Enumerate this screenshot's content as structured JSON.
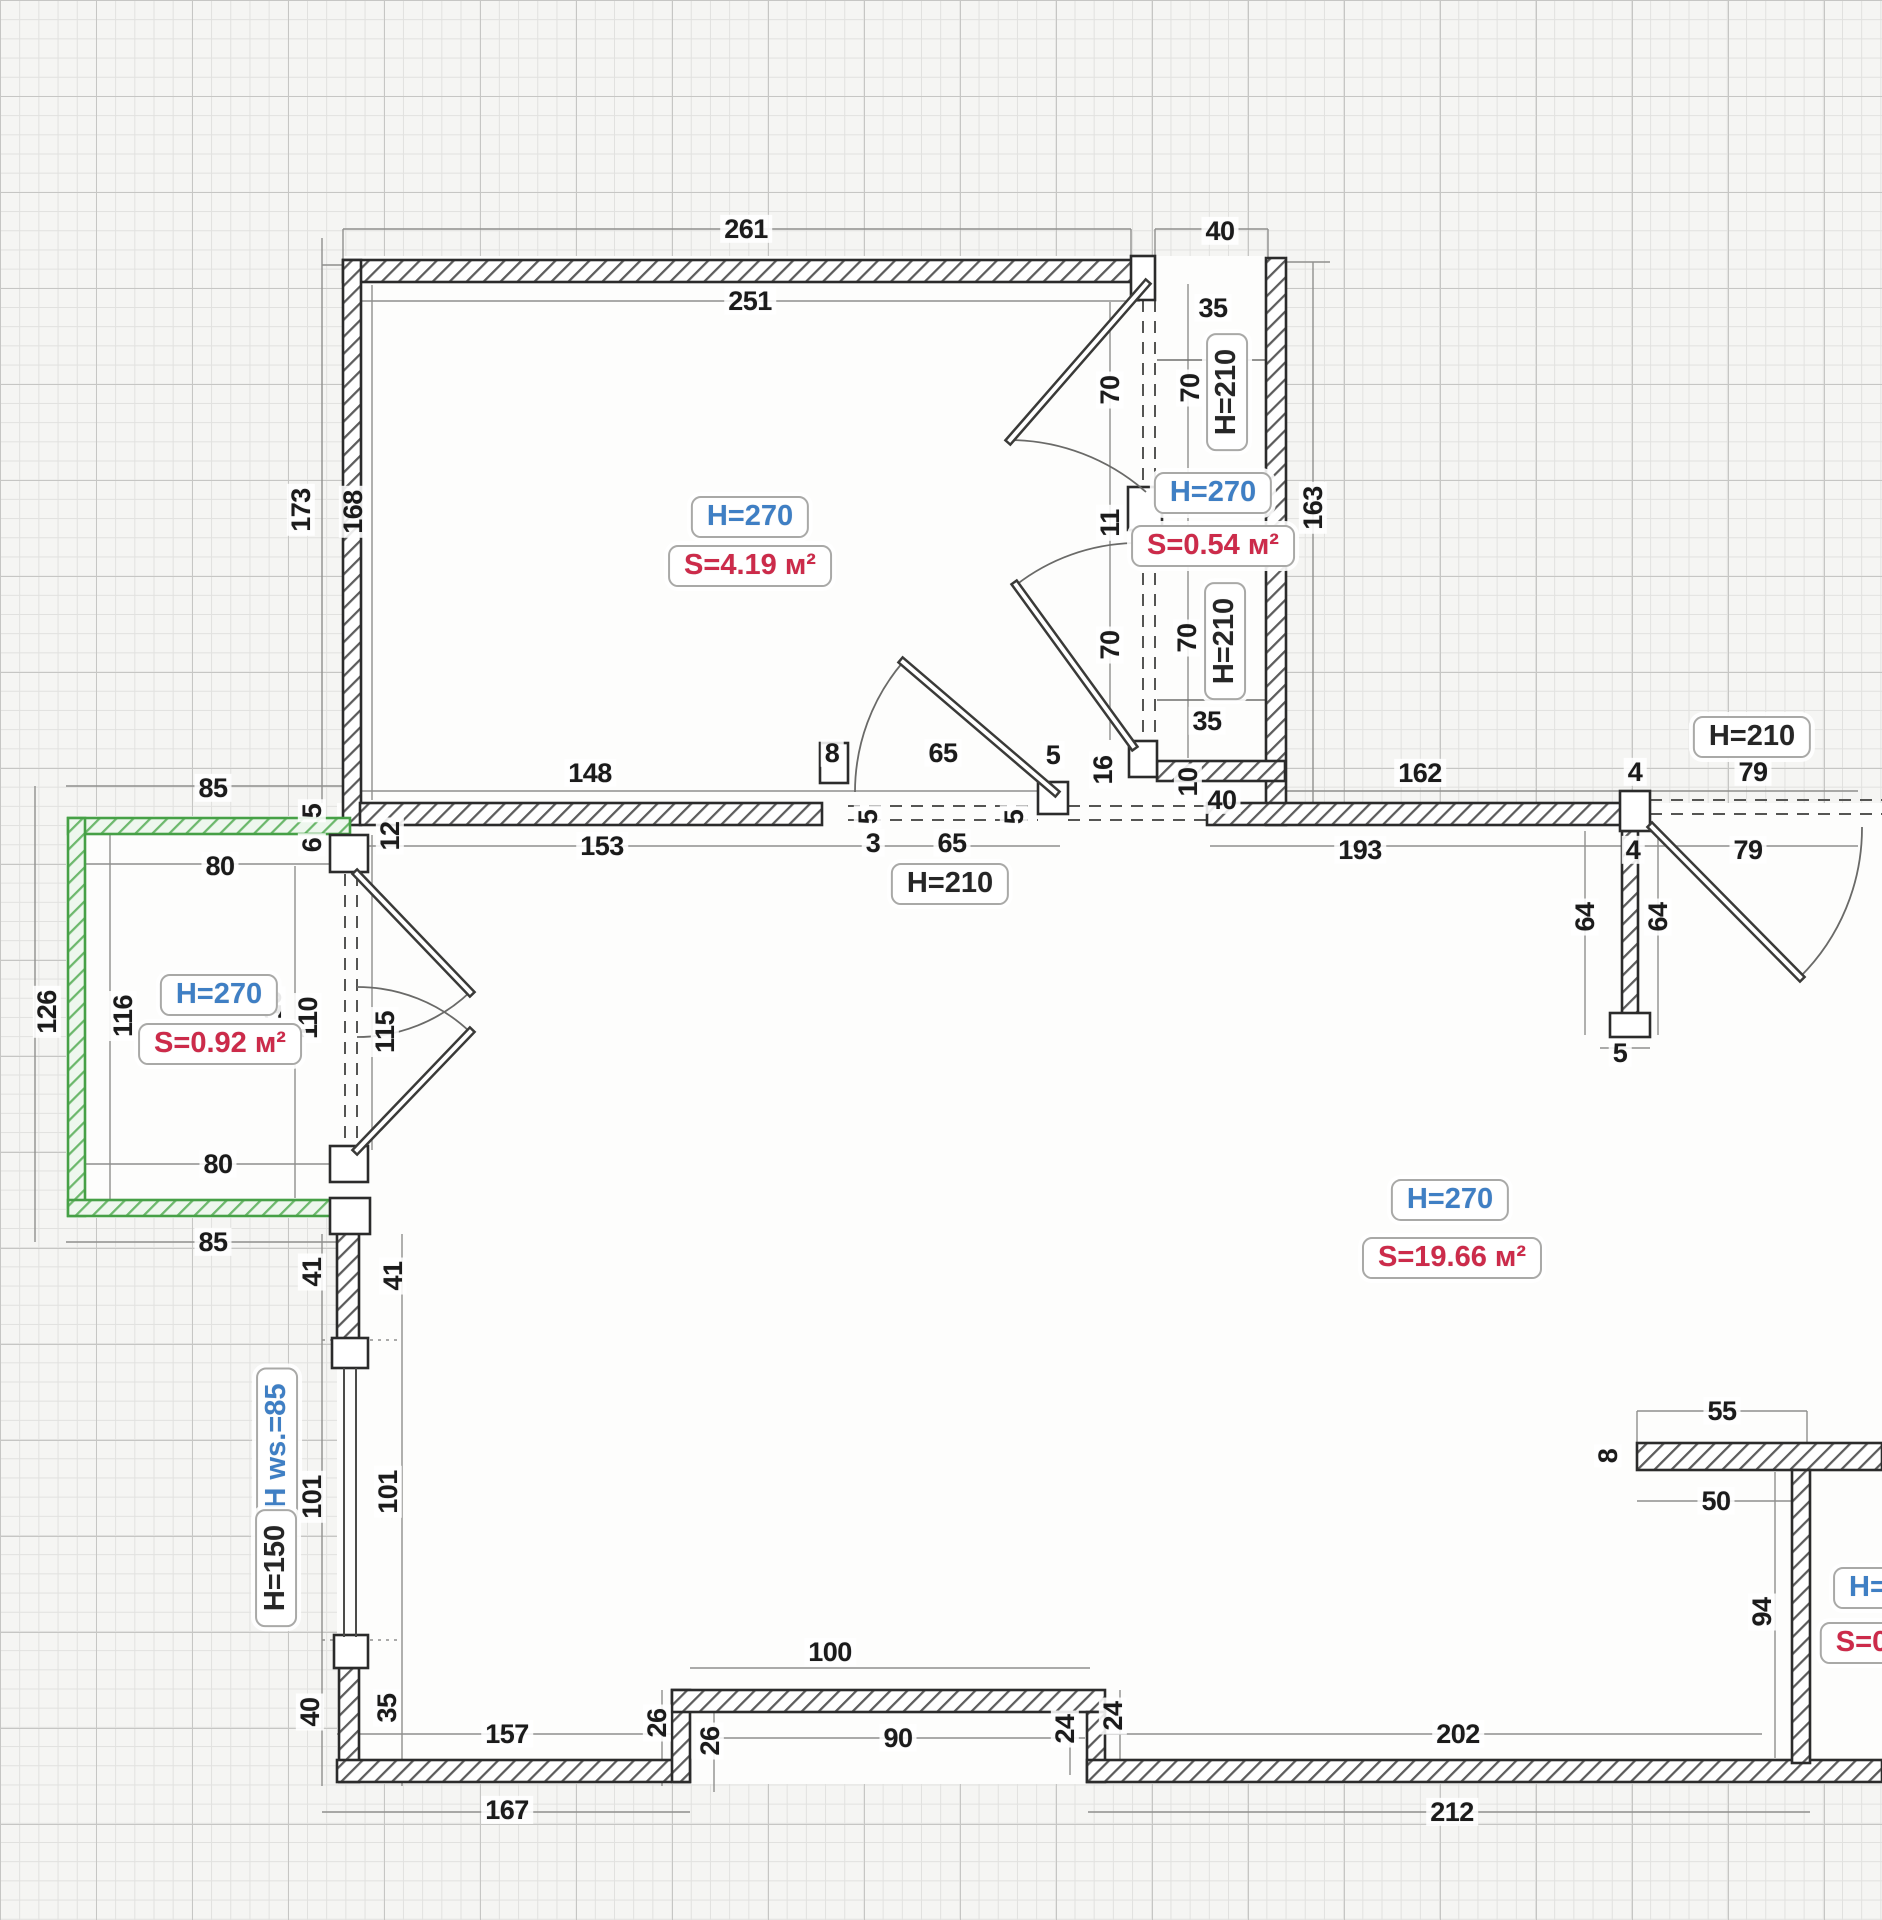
{
  "document": {
    "kind": "apartment floor plan drawing",
    "units_note": "dimensions shown in centimeters"
  },
  "colors": {
    "paper": "#f5f5f3",
    "grid_minor": "#e1e1df",
    "grid_major": "#c6c6c4",
    "wall_outline": "#2b2b2b",
    "green_wall": "#46a046",
    "label_blue": "#3f7fc4",
    "label_red": "#cc2b4a",
    "dim_text": "#1b1b1b"
  },
  "rooms": [
    {
      "name": "top-room",
      "height_label": "H=270",
      "area_label": "S=4.19 м²"
    },
    {
      "name": "closet",
      "height_label": "H=270",
      "area_label": "S=0.54 м²"
    },
    {
      "name": "balcony",
      "height_label": "H=270",
      "area_label": "S=0.92 м²"
    },
    {
      "name": "main-room",
      "height_label": "H=270",
      "area_label": "S=19.66 м²"
    },
    {
      "name": "right-room-cutoff",
      "height_label": "H=",
      "area_label": "S=0"
    }
  ],
  "labels": {
    "boxed": [
      {
        "text": "H=270",
        "style": "blue",
        "x": 750,
        "y": 517,
        "rot": false
      },
      {
        "text": "S=4.19 м²",
        "style": "red",
        "x": 750,
        "y": 566,
        "rot": false
      },
      {
        "text": "H=270",
        "style": "blue",
        "x": 1213,
        "y": 493,
        "rot": false
      },
      {
        "text": "S=0.54 м²",
        "style": "red",
        "x": 1213,
        "y": 546,
        "rot": false
      },
      {
        "text": "H=270",
        "style": "blue",
        "x": 219,
        "y": 995,
        "rot": false
      },
      {
        "text": "S=0.92 м²",
        "style": "red",
        "x": 220,
        "y": 1044,
        "rot": false
      },
      {
        "text": "H=270",
        "style": "blue",
        "x": 1450,
        "y": 1200,
        "rot": false
      },
      {
        "text": "S=19.66 м²",
        "style": "red",
        "x": 1452,
        "y": 1258,
        "rot": false
      },
      {
        "text": "H=210",
        "style": "black",
        "x": 950,
        "y": 884,
        "rot": false
      },
      {
        "text": "H=210",
        "style": "black",
        "x": 1752,
        "y": 737,
        "rot": false
      },
      {
        "text": "H=210",
        "style": "black",
        "x": 1227,
        "y": 392,
        "rot": true
      },
      {
        "text": "H=210",
        "style": "black",
        "x": 1225,
        "y": 641,
        "rot": true
      },
      {
        "text": "H ws.=85",
        "style": "blue",
        "x": 277,
        "y": 1446,
        "rot": true
      },
      {
        "text": "H=150",
        "style": "black",
        "x": 276,
        "y": 1568,
        "rot": true
      },
      {
        "text": "H=",
        "style": "blue",
        "x": 1868,
        "y": 1588,
        "rot": false
      },
      {
        "text": "S=0",
        "style": "red",
        "x": 1862,
        "y": 1643,
        "rot": false
      }
    ],
    "dims": [
      {
        "text": "261",
        "x": 746,
        "y": 229,
        "rot": false
      },
      {
        "text": "40",
        "x": 1220,
        "y": 231,
        "rot": false
      },
      {
        "text": "251",
        "x": 750,
        "y": 301,
        "rot": false
      },
      {
        "text": "173",
        "x": 301,
        "y": 510,
        "rot": true
      },
      {
        "text": "168",
        "x": 353,
        "y": 512,
        "rot": true
      },
      {
        "text": "35",
        "x": 1213,
        "y": 308,
        "rot": false
      },
      {
        "text": "70",
        "x": 1110,
        "y": 390,
        "rot": true
      },
      {
        "text": "70",
        "x": 1190,
        "y": 388,
        "rot": true
      },
      {
        "text": "11",
        "x": 1110,
        "y": 523,
        "rot": true
      },
      {
        "text": "70",
        "x": 1110,
        "y": 645,
        "rot": true
      },
      {
        "text": "70",
        "x": 1187,
        "y": 638,
        "rot": true
      },
      {
        "text": "35",
        "x": 1207,
        "y": 721,
        "rot": false
      },
      {
        "text": "163",
        "x": 1313,
        "y": 508,
        "rot": true
      },
      {
        "text": "148",
        "x": 590,
        "y": 773,
        "rot": false
      },
      {
        "text": "8",
        "x": 832,
        "y": 753,
        "rot": false
      },
      {
        "text": "65",
        "x": 943,
        "y": 753,
        "rot": false
      },
      {
        "text": "5",
        "x": 1053,
        "y": 755,
        "rot": false
      },
      {
        "text": "153",
        "x": 602,
        "y": 846,
        "rot": false
      },
      {
        "text": "3",
        "x": 873,
        "y": 843,
        "rot": false
      },
      {
        "text": "65",
        "x": 952,
        "y": 843,
        "rot": false
      },
      {
        "text": "5",
        "x": 868,
        "y": 817,
        "rot": true
      },
      {
        "text": "5",
        "x": 1014,
        "y": 817,
        "rot": true
      },
      {
        "text": "16",
        "x": 1103,
        "y": 770,
        "rot": true
      },
      {
        "text": "10",
        "x": 1188,
        "y": 782,
        "rot": true
      },
      {
        "text": "40",
        "x": 1222,
        "y": 800,
        "rot": false
      },
      {
        "text": "162",
        "x": 1420,
        "y": 773,
        "rot": false
      },
      {
        "text": "4",
        "x": 1635,
        "y": 772,
        "rot": false
      },
      {
        "text": "79",
        "x": 1753,
        "y": 772,
        "rot": false
      },
      {
        "text": "193",
        "x": 1360,
        "y": 850,
        "rot": false
      },
      {
        "text": "4",
        "x": 1633,
        "y": 850,
        "rot": false
      },
      {
        "text": "79",
        "x": 1748,
        "y": 850,
        "rot": false
      },
      {
        "text": "64",
        "x": 1585,
        "y": 917,
        "rot": true
      },
      {
        "text": "64",
        "x": 1658,
        "y": 917,
        "rot": true
      },
      {
        "text": "5",
        "x": 1620,
        "y": 1053,
        "rot": false
      },
      {
        "text": "85",
        "x": 213,
        "y": 788,
        "rot": false
      },
      {
        "text": "80",
        "x": 220,
        "y": 866,
        "rot": false
      },
      {
        "text": "126",
        "x": 47,
        "y": 1012,
        "rot": true
      },
      {
        "text": "116",
        "x": 123,
        "y": 1016,
        "rot": true
      },
      {
        "text": "10",
        "x": 272,
        "y": 1005,
        "rot": true
      },
      {
        "text": "110",
        "x": 308,
        "y": 1018,
        "rot": true
      },
      {
        "text": "115",
        "x": 385,
        "y": 1032,
        "rot": true
      },
      {
        "text": "5",
        "x": 312,
        "y": 811,
        "rot": true
      },
      {
        "text": "6",
        "x": 312,
        "y": 845,
        "rot": true
      },
      {
        "text": "12",
        "x": 390,
        "y": 836,
        "rot": true
      },
      {
        "text": "80",
        "x": 218,
        "y": 1164,
        "rot": false
      },
      {
        "text": "85",
        "x": 213,
        "y": 1242,
        "rot": false
      },
      {
        "text": "41",
        "x": 312,
        "y": 1272,
        "rot": true
      },
      {
        "text": "41",
        "x": 393,
        "y": 1276,
        "rot": true
      },
      {
        "text": "101",
        "x": 312,
        "y": 1497,
        "rot": true
      },
      {
        "text": "101",
        "x": 388,
        "y": 1492,
        "rot": true
      },
      {
        "text": "40",
        "x": 310,
        "y": 1712,
        "rot": true
      },
      {
        "text": "35",
        "x": 387,
        "y": 1708,
        "rot": true
      },
      {
        "text": "157",
        "x": 507,
        "y": 1734,
        "rot": false
      },
      {
        "text": "26",
        "x": 657,
        "y": 1723,
        "rot": true
      },
      {
        "text": "26",
        "x": 710,
        "y": 1741,
        "rot": true
      },
      {
        "text": "100",
        "x": 830,
        "y": 1652,
        "rot": false
      },
      {
        "text": "90",
        "x": 898,
        "y": 1738,
        "rot": false
      },
      {
        "text": "24",
        "x": 1065,
        "y": 1729,
        "rot": true
      },
      {
        "text": "24",
        "x": 1113,
        "y": 1716,
        "rot": true
      },
      {
        "text": "202",
        "x": 1458,
        "y": 1734,
        "rot": false
      },
      {
        "text": "167",
        "x": 507,
        "y": 1810,
        "rot": false
      },
      {
        "text": "212",
        "x": 1452,
        "y": 1812,
        "rot": false
      },
      {
        "text": "55",
        "x": 1722,
        "y": 1411,
        "rot": false
      },
      {
        "text": "8",
        "x": 1608,
        "y": 1456,
        "rot": true
      },
      {
        "text": "50",
        "x": 1716,
        "y": 1501,
        "rot": false
      },
      {
        "text": "94",
        "x": 1762,
        "y": 1612,
        "rot": true
      }
    ]
  }
}
